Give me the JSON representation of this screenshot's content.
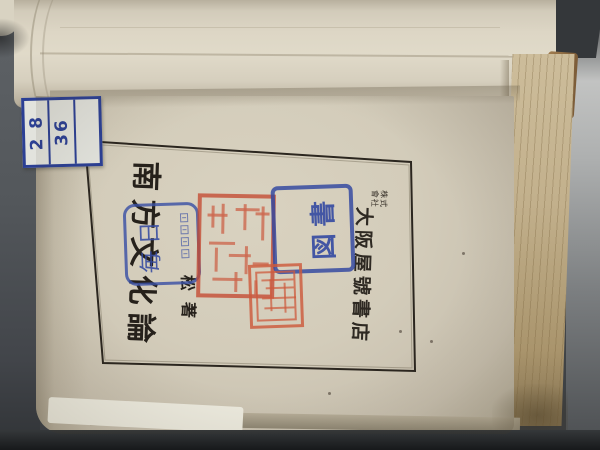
{
  "scene": {
    "description": "Photograph of an open Japanese book lying rotated 90 degrees; title page with printed frame, library stamps, red seals and a call-number label",
    "orientation": "page text rotated 90 degrees in photo"
  },
  "colors": {
    "background": "#4c5054",
    "page": "#d3ccba",
    "frame_line": "#2b261f",
    "title_ink": "#26211b",
    "label_blue": "#2b3f94",
    "stamp_blue": "#3a50a5",
    "seal_red": "#c4492f",
    "fore_edge": "#c2b08c",
    "board_brown": "#8a6743"
  },
  "label": {
    "cells": [
      "2 8",
      "36",
      ""
    ]
  },
  "title_page": {
    "title": "南方文化論",
    "author_char1": "松",
    "author_char2": "著",
    "publisher_company_line1": "株式",
    "publisher_company_line2": "會社",
    "publisher": "大阪屋號書店"
  },
  "stamps": {
    "rounded_blue": {
      "text": "毎日",
      "small_text_legible": false
    },
    "rect_blue": {
      "text": "図書"
    },
    "red_seal_large": {
      "legible": false
    },
    "red_seal_small": {
      "legible": false
    }
  }
}
